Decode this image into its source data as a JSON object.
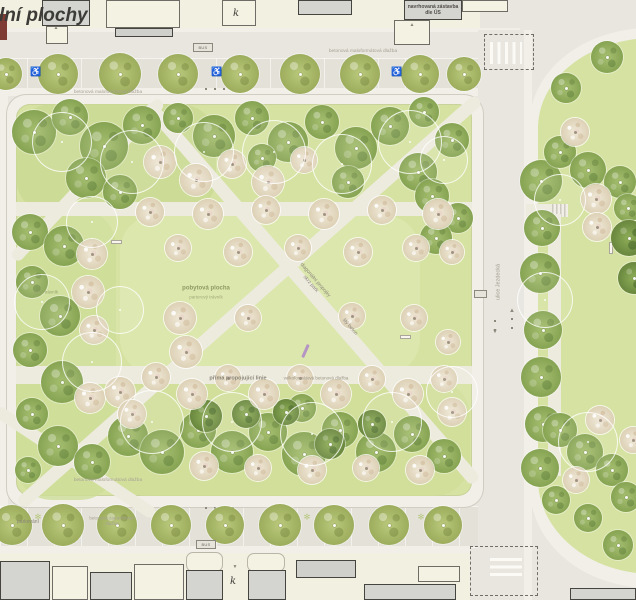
{
  "plan": {
    "canvas": {
      "w": 636,
      "h": 600
    },
    "colors": {
      "lawn": "#d6e2a2",
      "road": "#e8e6df",
      "walk": "#f1efe8",
      "parking": "#e3e1d8",
      "cream": "#f2f0e0",
      "bgray": "#d4d4d1",
      "outline": "#45443f",
      "tree_green": "#94ad61",
      "tree_blossom": "#e6dcc6",
      "accent_purple": "#b08cc6"
    },
    "labels": [
      {
        "t": "ální plochy",
        "x": 38,
        "y": 16,
        "fs": 19,
        "c": "#3c3b37",
        "w": 800,
        "i": 1,
        "n": "plan-title-partial"
      },
      {
        "t": "navrhovaná zástavba\ndle ÚS",
        "x": 433,
        "y": 10,
        "fs": 5,
        "c": "#4e4c47",
        "w": 600,
        "n": "building-label-proposed-development"
      },
      {
        "t": "betonová maloformátová dlažba",
        "x": 363,
        "y": 51,
        "fs": 4.8,
        "c": "#a9a295",
        "n": "surface-label-top-road"
      },
      {
        "t": "betonová maloformátová dlažba",
        "x": 108,
        "y": 92,
        "fs": 4.8,
        "c": "#a9a295",
        "n": "surface-label-top-walk"
      },
      {
        "t": "pobytová plocha",
        "x": 206,
        "y": 289,
        "fs": 6,
        "c": "#8d9a63",
        "w": 700,
        "n": "lawn-label"
      },
      {
        "t": "parterový trávník",
        "x": 206,
        "y": 297,
        "fs": 4.5,
        "c": "#a0a977",
        "n": "lawn-sublabel"
      },
      {
        "t": "luční trávník",
        "x": 46,
        "y": 292,
        "fs": 4.5,
        "c": "#99a471",
        "n": "meadow-label"
      },
      {
        "t": "diagonální propojky\nskrz park",
        "x": 313,
        "y": 282,
        "fs": 5,
        "c": "#8d887b",
        "r": 49,
        "n": "path-label-diagonal"
      },
      {
        "t": "litý beton",
        "x": 350,
        "y": 327,
        "fs": 5,
        "c": "#8d887b",
        "r": 49,
        "n": "path-label-material"
      },
      {
        "t": "přímá propojující linie",
        "x": 238,
        "y": 378,
        "fs": 5.5,
        "c": "#8a8578",
        "w": 600,
        "n": "path-label-straight-line"
      },
      {
        "t": "velkoformátová betonová dlažba",
        "x": 316,
        "y": 378,
        "fs": 4.5,
        "c": "#9a9486",
        "n": "path-label-paving"
      },
      {
        "t": "betonová maloformátová dlažba",
        "x": 108,
        "y": 480,
        "fs": 4.8,
        "c": "#a9a295",
        "n": "surface-label-bottom-walk"
      },
      {
        "t": "parkování",
        "x": 28,
        "y": 522,
        "fs": 5,
        "c": "#8a8578",
        "n": "parking-label"
      },
      {
        "t": "betonová zatravňovací\ndlažba",
        "x": 112,
        "y": 521,
        "fs": 4.5,
        "c": "#a9a295",
        "n": "surface-label-grass-paving"
      },
      {
        "t": "ulice Jezdecká",
        "x": 498,
        "y": 282,
        "fs": 5.5,
        "c": "#a19b8e",
        "r": -90,
        "n": "street-name-label"
      },
      {
        "t": "k",
        "x": 236,
        "y": 14,
        "fs": 10,
        "c": "#3c3b37",
        "i": 1,
        "f": "serif",
        "n": "building-letter"
      },
      {
        "t": "k",
        "x": 233,
        "y": 582,
        "fs": 10,
        "c": "#3c3b37",
        "i": 1,
        "f": "serif",
        "n": "building-letter"
      }
    ],
    "icons": [
      {
        "g": "♿",
        "x": 36,
        "y": 72,
        "fs": 9,
        "c": "#ffffff",
        "n": "wheelchair-parking-icon"
      },
      {
        "g": "♿",
        "x": 217,
        "y": 72,
        "fs": 9,
        "c": "#ffffff",
        "n": "wheelchair-parking-icon"
      },
      {
        "g": "♿",
        "x": 397,
        "y": 72,
        "fs": 9,
        "c": "#ffffff",
        "n": "wheelchair-parking-icon"
      },
      {
        "g": "✻",
        "x": 38,
        "y": 517,
        "fs": 8,
        "c": "#b7c87f",
        "n": "planting-star-icon"
      },
      {
        "g": "✻",
        "x": 307,
        "y": 517,
        "fs": 8,
        "c": "#b7c87f",
        "n": "planting-star-icon"
      },
      {
        "g": "✻",
        "x": 421,
        "y": 517,
        "fs": 8,
        "c": "#b7c87f",
        "n": "planting-star-icon"
      },
      {
        "g": "▲",
        "x": 56,
        "y": 28,
        "fs": 5,
        "c": "#8a8578",
        "n": "entrance-marker-icon"
      },
      {
        "g": "▲",
        "x": 412,
        "y": 25,
        "fs": 5,
        "c": "#8a8578",
        "n": "entrance-marker-icon"
      },
      {
        "g": "▼",
        "x": 235,
        "y": 567,
        "fs": 5,
        "c": "#8a8578",
        "n": "entrance-marker-icon"
      },
      {
        "g": "▲",
        "x": 512,
        "y": 310,
        "fs": 6,
        "c": "#8d887c",
        "n": "lane-arrow-up-icon"
      },
      {
        "g": "▼",
        "x": 495,
        "y": 331,
        "fs": 6,
        "c": "#8d887c",
        "n": "lane-arrow-down-icon"
      }
    ],
    "badges": [
      [
        193,
        43,
        20,
        9,
        "BUS"
      ],
      [
        196,
        540,
        20,
        9,
        "BUS"
      ],
      [
        474,
        290,
        13,
        8,
        ""
      ]
    ],
    "benches": [
      [
        111,
        240,
        11,
        4
      ],
      [
        400,
        335,
        11,
        4
      ],
      [
        609,
        242,
        4,
        12
      ]
    ],
    "purple_marker": {
      "x": 304,
      "y": 344,
      "w": 3,
      "h": 14,
      "rot": 24
    },
    "dotted_lines": [
      [
        205,
        88,
        34,
        "h"
      ],
      [
        205,
        507,
        34,
        "h"
      ],
      [
        511,
        315,
        14,
        "v"
      ],
      [
        494,
        317,
        14,
        "v"
      ]
    ],
    "buildings": [
      [
        0,
        14,
        7,
        26,
        "r"
      ],
      [
        42,
        0,
        48,
        26,
        "g"
      ],
      [
        46,
        26,
        22,
        18,
        "c"
      ],
      [
        106,
        0,
        74,
        28,
        "c"
      ],
      [
        115,
        28,
        58,
        9,
        "bar"
      ],
      [
        222,
        0,
        34,
        26,
        "c"
      ],
      [
        298,
        0,
        54,
        15,
        "g"
      ],
      [
        404,
        0,
        58,
        20,
        "g"
      ],
      [
        394,
        20,
        36,
        25,
        "c"
      ],
      [
        462,
        0,
        46,
        12,
        "c"
      ],
      [
        0,
        561,
        50,
        39,
        "g"
      ],
      [
        52,
        566,
        36,
        34,
        "c"
      ],
      [
        90,
        572,
        42,
        28,
        "g"
      ],
      [
        134,
        564,
        50,
        36,
        "c"
      ],
      [
        186,
        552,
        37,
        20,
        "cr"
      ],
      [
        247,
        553,
        38,
        19,
        "cr"
      ],
      [
        186,
        570,
        37,
        30,
        "g"
      ],
      [
        248,
        570,
        38,
        30,
        "g"
      ],
      [
        296,
        560,
        60,
        18,
        "bar"
      ],
      [
        364,
        584,
        92,
        16,
        "g"
      ],
      [
        418,
        566,
        42,
        16,
        "c"
      ],
      [
        570,
        588,
        66,
        12,
        "g"
      ]
    ],
    "trees": [
      [
        6,
        74,
        16,
        "s"
      ],
      [
        58,
        74,
        20,
        "s"
      ],
      [
        120,
        74,
        21,
        "s"
      ],
      [
        178,
        74,
        20,
        "s"
      ],
      [
        240,
        74,
        19,
        "s"
      ],
      [
        300,
        74,
        20,
        "s"
      ],
      [
        360,
        74,
        20,
        "s"
      ],
      [
        420,
        74,
        19,
        "s"
      ],
      [
        464,
        74,
        17,
        "s"
      ],
      [
        12,
        525,
        20,
        "s"
      ],
      [
        63,
        525,
        21,
        "s"
      ],
      [
        117,
        525,
        20,
        "s"
      ],
      [
        171,
        525,
        20,
        "s"
      ],
      [
        225,
        525,
        19,
        "s"
      ],
      [
        280,
        525,
        21,
        "s"
      ],
      [
        334,
        525,
        20,
        "s"
      ],
      [
        389,
        525,
        20,
        "s"
      ],
      [
        443,
        525,
        19,
        "s"
      ],
      [
        34,
        132,
        22,
        "g"
      ],
      [
        70,
        117,
        18,
        "g"
      ],
      [
        104,
        146,
        24,
        "g"
      ],
      [
        142,
        125,
        19,
        "g"
      ],
      [
        86,
        178,
        20,
        "g"
      ],
      [
        120,
        192,
        17,
        "g"
      ],
      [
        178,
        118,
        15,
        "g"
      ],
      [
        214,
        136,
        21,
        "g"
      ],
      [
        252,
        118,
        17,
        "g"
      ],
      [
        288,
        142,
        20,
        "g"
      ],
      [
        322,
        122,
        17,
        "g"
      ],
      [
        356,
        148,
        21,
        "g"
      ],
      [
        390,
        126,
        19,
        "g"
      ],
      [
        424,
        112,
        15,
        "g"
      ],
      [
        452,
        140,
        17,
        "g"
      ],
      [
        418,
        172,
        19,
        "g"
      ],
      [
        348,
        182,
        16,
        "g"
      ],
      [
        262,
        158,
        14,
        "g"
      ],
      [
        30,
        232,
        18,
        "g"
      ],
      [
        64,
        246,
        20,
        "g"
      ],
      [
        32,
        282,
        16,
        "g"
      ],
      [
        60,
        316,
        20,
        "g"
      ],
      [
        30,
        350,
        17,
        "g"
      ],
      [
        62,
        382,
        21,
        "g"
      ],
      [
        32,
        414,
        16,
        "g"
      ],
      [
        58,
        446,
        20,
        "g"
      ],
      [
        92,
        462,
        18,
        "g"
      ],
      [
        28,
        470,
        13,
        "g"
      ],
      [
        128,
        436,
        20,
        "g"
      ],
      [
        162,
        452,
        22,
        "g"
      ],
      [
        198,
        430,
        18,
        "g"
      ],
      [
        232,
        452,
        21,
        "g"
      ],
      [
        268,
        432,
        19,
        "g"
      ],
      [
        304,
        454,
        22,
        "g"
      ],
      [
        340,
        430,
        18,
        "g"
      ],
      [
        376,
        452,
        20,
        "g"
      ],
      [
        412,
        434,
        18,
        "g"
      ],
      [
        444,
        456,
        17,
        "g"
      ],
      [
        302,
        408,
        14,
        "g"
      ],
      [
        432,
        196,
        17,
        "g"
      ],
      [
        458,
        218,
        15,
        "g"
      ],
      [
        436,
        238,
        16,
        "g"
      ],
      [
        206,
        416,
        16,
        "d"
      ],
      [
        246,
        414,
        14,
        "d"
      ],
      [
        286,
        412,
        13,
        "d"
      ],
      [
        372,
        424,
        14,
        "d"
      ],
      [
        330,
        444,
        15,
        "d"
      ],
      [
        160,
        162,
        16,
        "b"
      ],
      [
        196,
        180,
        16,
        "b"
      ],
      [
        232,
        164,
        14,
        "b"
      ],
      [
        268,
        182,
        16,
        "b"
      ],
      [
        304,
        160,
        13,
        "b"
      ],
      [
        150,
        212,
        14,
        "b"
      ],
      [
        208,
        214,
        15,
        "b"
      ],
      [
        266,
        210,
        14,
        "b"
      ],
      [
        324,
        214,
        15,
        "b"
      ],
      [
        382,
        210,
        14,
        "b"
      ],
      [
        438,
        214,
        15,
        "b"
      ],
      [
        178,
        248,
        13,
        "b"
      ],
      [
        238,
        252,
        14,
        "b"
      ],
      [
        298,
        248,
        13,
        "b"
      ],
      [
        358,
        252,
        14,
        "b"
      ],
      [
        416,
        248,
        13,
        "b"
      ],
      [
        452,
        252,
        12,
        "b"
      ],
      [
        180,
        318,
        16,
        "b"
      ],
      [
        186,
        352,
        16,
        "b"
      ],
      [
        248,
        318,
        13,
        "b"
      ],
      [
        352,
        316,
        13,
        "b"
      ],
      [
        414,
        318,
        13,
        "b"
      ],
      [
        448,
        342,
        12,
        "b"
      ],
      [
        92,
        254,
        15,
        "b"
      ],
      [
        88,
        292,
        16,
        "b"
      ],
      [
        94,
        330,
        14,
        "b"
      ],
      [
        90,
        398,
        15,
        "b"
      ],
      [
        120,
        392,
        15,
        "b"
      ],
      [
        156,
        377,
        14,
        "b"
      ],
      [
        192,
        394,
        15,
        "b"
      ],
      [
        228,
        378,
        13,
        "b"
      ],
      [
        264,
        394,
        15,
        "b"
      ],
      [
        300,
        378,
        13,
        "b"
      ],
      [
        336,
        394,
        15,
        "b"
      ],
      [
        372,
        379,
        13,
        "b"
      ],
      [
        408,
        394,
        15,
        "b"
      ],
      [
        444,
        379,
        13,
        "b"
      ],
      [
        132,
        414,
        14,
        "b"
      ],
      [
        452,
        412,
        14,
        "b"
      ],
      [
        204,
        466,
        14,
        "b"
      ],
      [
        258,
        468,
        13,
        "b"
      ],
      [
        312,
        470,
        14,
        "b"
      ],
      [
        366,
        468,
        13,
        "b"
      ],
      [
        420,
        470,
        14,
        "b"
      ],
      [
        62,
        142,
        30,
        "o"
      ],
      [
        132,
        162,
        32,
        "o"
      ],
      [
        204,
        152,
        30,
        "o"
      ],
      [
        274,
        152,
        32,
        "o"
      ],
      [
        342,
        164,
        30,
        "o"
      ],
      [
        410,
        142,
        32,
        "o"
      ],
      [
        92,
        222,
        26,
        "o"
      ],
      [
        42,
        302,
        28,
        "o"
      ],
      [
        92,
        362,
        30,
        "o"
      ],
      [
        152,
        422,
        32,
        "o"
      ],
      [
        232,
        422,
        30,
        "o"
      ],
      [
        312,
        434,
        32,
        "o"
      ],
      [
        392,
        422,
        30,
        "o"
      ],
      [
        452,
        392,
        26,
        "o"
      ],
      [
        444,
        160,
        24,
        "o"
      ],
      [
        120,
        310,
        24,
        "o"
      ],
      [
        566,
        88,
        15,
        "g"
      ],
      [
        607,
        57,
        16,
        "g"
      ],
      [
        541,
        181,
        21,
        "g"
      ],
      [
        542,
        228,
        18,
        "g"
      ],
      [
        540,
        273,
        20,
        "g"
      ],
      [
        543,
        330,
        19,
        "g"
      ],
      [
        541,
        377,
        20,
        "g"
      ],
      [
        543,
        424,
        18,
        "g"
      ],
      [
        540,
        468,
        19,
        "g"
      ],
      [
        560,
        152,
        16,
        "g"
      ],
      [
        588,
        170,
        18,
        "g"
      ],
      [
        620,
        182,
        16,
        "g"
      ],
      [
        628,
        208,
        14,
        "g"
      ],
      [
        560,
        430,
        17,
        "g"
      ],
      [
        585,
        452,
        18,
        "g"
      ],
      [
        612,
        470,
        16,
        "g"
      ],
      [
        626,
        497,
        15,
        "g"
      ],
      [
        556,
        500,
        14,
        "g"
      ],
      [
        588,
        518,
        14,
        "g"
      ],
      [
        618,
        545,
        15,
        "g"
      ],
      [
        575,
        132,
        14,
        "b"
      ],
      [
        596,
        199,
        15,
        "b"
      ],
      [
        597,
        227,
        14,
        "b"
      ],
      [
        576,
        480,
        13,
        "b"
      ],
      [
        600,
        420,
        14,
        "b"
      ],
      [
        633,
        440,
        13,
        "b"
      ],
      [
        629,
        238,
        18,
        "d"
      ],
      [
        634,
        278,
        16,
        "d"
      ],
      [
        560,
        200,
        26,
        "o"
      ],
      [
        545,
        300,
        28,
        "o"
      ],
      [
        588,
        442,
        30,
        "o"
      ]
    ]
  }
}
